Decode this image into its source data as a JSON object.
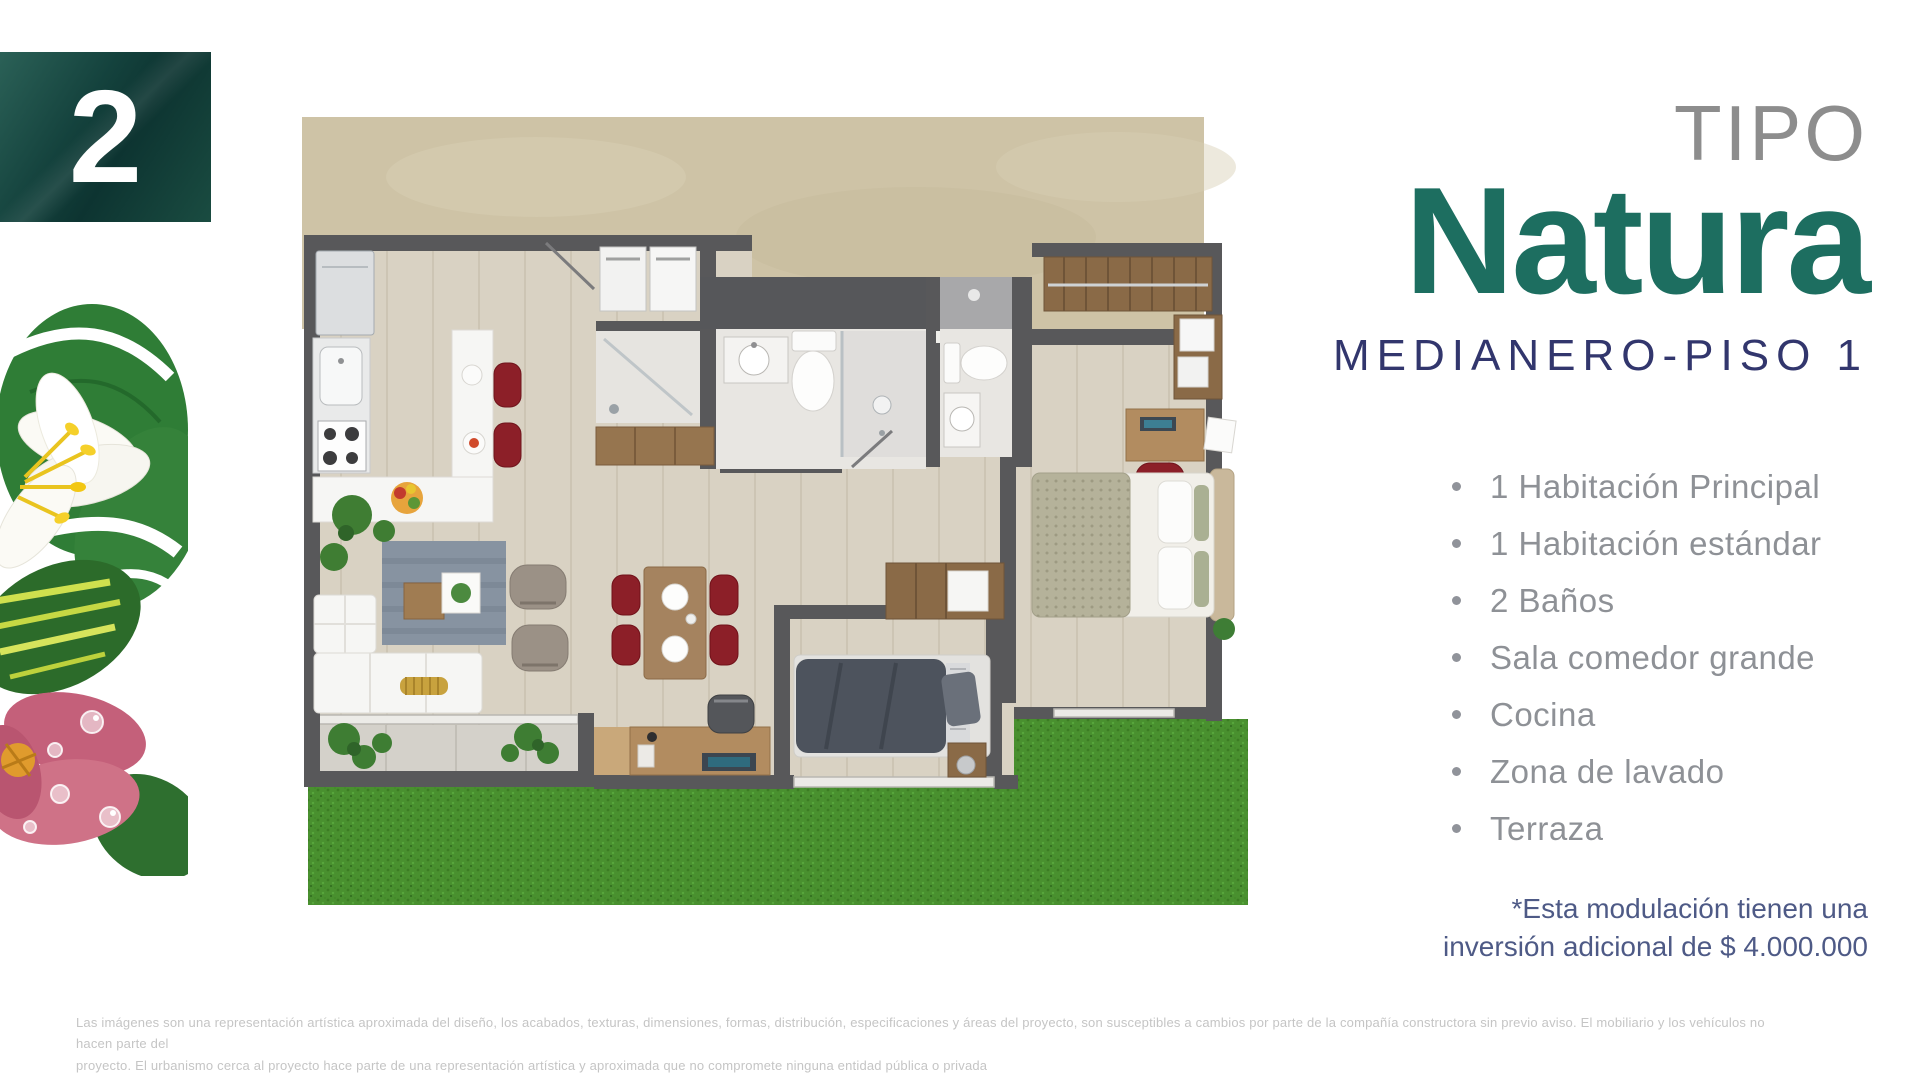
{
  "badge": {
    "number": "2"
  },
  "title": {
    "kicker": "TIPO",
    "name": "Natura",
    "subtitle": "MEDIANERO-PISO 1"
  },
  "features": [
    "1 Habitación Principal",
    "1 Habitación estándar",
    "2 Baños",
    "Sala comedor grande",
    "Cocina",
    "Zona de lavado",
    "Terraza"
  ],
  "note": {
    "line1": "*Esta modulación tienen  una",
    "line2": "inversión adicional de $ 4.000.000"
  },
  "disclaimer": {
    "line1": "Las imágenes son una representación artística aproximada del diseño, los acabados, texturas, dimensiones, formas, distribución, especificaciones y áreas del proyecto, son susceptibles a cambios por parte de la compañía constructora sin previo aviso. El mobiliario y los vehículos no hacen parte del",
    "line2": "proyecto. El urbanismo cerca al proyecto hace parte de una representación artística y aproximada que no compromete ninguna entidad pública o privada"
  },
  "images": {
    "floorplan": "apartment-floor-plan-top-view",
    "flower": "tropical-flowers-illustration"
  },
  "colors": {
    "brand_teal": "#1d6e60",
    "badge_teal_dark": "#0d3431",
    "subtitle_navy": "#32366d",
    "feature_gray": "#8e9196",
    "note_blue": "#4e5a86",
    "disclaimer_gray": "#c5c5c5",
    "grass_green": "#49902f",
    "wall_gray": "#58585a",
    "floor_beige": "#d9d2c3"
  }
}
